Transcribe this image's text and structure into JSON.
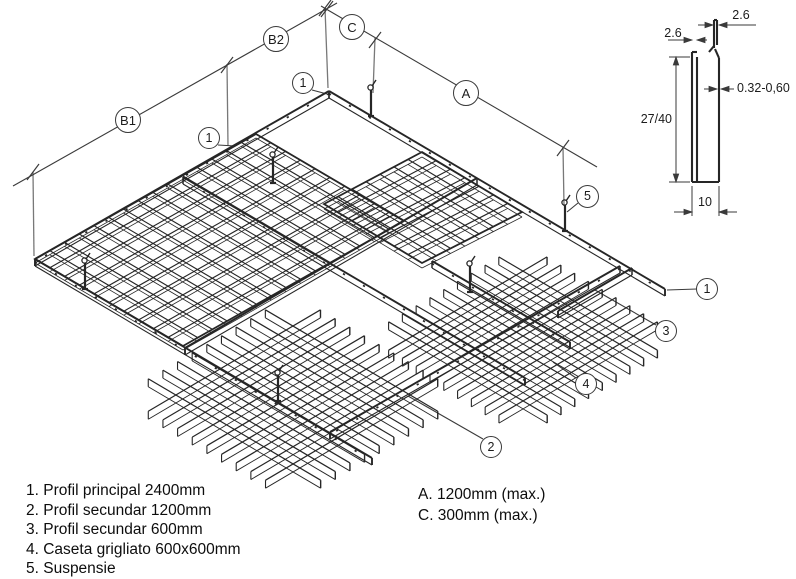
{
  "legend": {
    "items": [
      "1. Profil principal 2400mm",
      "2. Profil secundar 1200mm",
      "3. Profil secundar 600mm",
      "4. Caseta grigliato 600x600mm",
      "5. Suspensie"
    ],
    "dims": [
      "A. 1200mm (max.)",
      "C. 300mm (max.)"
    ]
  },
  "callouts": {
    "b1": "B1",
    "b2": "B2",
    "c": "C",
    "a": "A",
    "one": "1",
    "two": "2",
    "three": "3",
    "four": "4",
    "five": "5"
  },
  "detail": {
    "top_fold": "2.6",
    "left_fold": "2.6",
    "thickness": "0.32-0,60",
    "height": "27/40",
    "width": "10"
  },
  "drawing": {
    "stroke": "#262626",
    "dim_stroke": "#3a3a3a",
    "ext_stroke": "#787878",
    "rails": [
      {
        "x1": 329,
        "y1": 91,
        "x2": 35,
        "y2": 259,
        "h": 7,
        "ticks": true
      },
      {
        "x1": 329,
        "y1": 91,
        "x2": 665,
        "y2": 289,
        "h": 7,
        "ticks": true
      },
      {
        "x1": 35,
        "y1": 259,
        "x2": 372,
        "y2": 458,
        "h": 7,
        "ticks": true
      },
      {
        "x1": 620,
        "y1": 266,
        "x2": 330,
        "y2": 432,
        "h": 7,
        "ticks": true
      },
      {
        "x1": 183,
        "y1": 177,
        "x2": 525,
        "y2": 378,
        "h": 7,
        "ticks": true
      },
      {
        "x1": 477,
        "y1": 178,
        "x2": 185,
        "y2": 348,
        "h": 7,
        "ticks": false
      },
      {
        "x1": 632,
        "y1": 268,
        "x2": 558,
        "y2": 311,
        "h": 7,
        "ticks": false
      },
      {
        "x1": 432,
        "y1": 261,
        "x2": 570,
        "y2": 342,
        "h": 7,
        "ticks": true
      }
    ],
    "panels": [
      {
        "top": [
          256,
          134
        ],
        "right": [
          404,
          221
        ],
        "bottom": [
          183,
          346
        ],
        "left": [
          35,
          259
        ],
        "nr": 10,
        "nl": 15,
        "depth": 4
      },
      {
        "top": [
          422,
          152
        ],
        "right": [
          522,
          212
        ],
        "bottom": [
          422,
          263
        ],
        "left": [
          324,
          204
        ],
        "nr": 7,
        "nl": 7,
        "depth": 5
      }
    ],
    "cassettes": [
      {
        "cx": 293,
        "cy": 395,
        "n": 9,
        "half": 100,
        "gap": 17,
        "depth": 8
      },
      {
        "cx": 523,
        "cy": 336,
        "n": 9,
        "half": 92,
        "gap": 16,
        "depth": 8
      }
    ],
    "hangers": [
      [
        371,
        116
      ],
      [
        273,
        183
      ],
      [
        85,
        289
      ],
      [
        565,
        231
      ],
      [
        470,
        292
      ],
      [
        278,
        401
      ]
    ],
    "dim_lines": [
      [
        337,
        3,
        13,
        186
      ],
      [
        321,
        6,
        597,
        167
      ]
    ],
    "dim_ticks": [
      [
        325,
        8
      ],
      [
        227,
        65
      ],
      [
        33,
        172
      ],
      [
        327,
        9
      ],
      [
        375,
        40
      ],
      [
        563,
        148
      ]
    ],
    "ext_lines": [
      [
        325,
        8,
        328,
        88
      ],
      [
        227,
        64,
        228,
        146
      ],
      [
        33,
        172,
        34,
        256
      ],
      [
        375,
        38,
        373,
        93
      ],
      [
        563,
        147,
        564,
        206
      ]
    ],
    "leaders": [
      [
        312,
        90,
        327,
        94
      ],
      [
        218,
        145,
        235,
        146
      ],
      [
        578,
        203,
        567,
        212
      ],
      [
        697,
        289,
        667,
        290
      ],
      [
        656,
        325,
        595,
        290
      ],
      [
        576,
        378,
        553,
        362
      ],
      [
        483,
        439,
        408,
        396
      ]
    ],
    "detail_profile": [
      [
        692,
        52,
        692,
        182
      ],
      [
        697,
        57,
        697,
        182
      ],
      [
        692,
        52,
        697,
        52
      ],
      [
        692,
        182,
        719,
        182
      ],
      [
        719,
        182,
        719,
        58
      ],
      [
        714,
        20,
        714,
        48
      ],
      [
        717,
        20,
        717,
        45
      ],
      [
        714,
        20,
        717,
        20
      ],
      [
        719,
        58,
        715,
        49
      ],
      [
        714,
        46,
        709,
        52
      ]
    ],
    "detail_dims": [
      [
        676,
        57,
        676,
        182
      ],
      [
        669,
        57,
        690,
        57
      ],
      [
        669,
        182,
        690,
        182
      ],
      [
        698,
        25,
        713,
        25
      ],
      [
        719,
        25,
        756,
        25
      ],
      [
        668,
        40,
        692,
        40
      ],
      [
        697,
        40,
        707,
        40
      ],
      [
        704,
        89,
        717,
        89
      ],
      [
        721,
        89,
        734,
        89
      ],
      [
        692,
        186,
        692,
        216
      ],
      [
        719,
        186,
        719,
        216
      ],
      [
        674,
        212,
        692,
        212
      ],
      [
        719,
        212,
        737,
        212
      ]
    ],
    "detail_arrows": [
      [
        713,
        25,
        "r"
      ],
      [
        719,
        25,
        "l"
      ],
      [
        692,
        40,
        "r"
      ],
      [
        697,
        40,
        "l"
      ],
      [
        717,
        89,
        "r"
      ],
      [
        721,
        89,
        "l"
      ],
      [
        676,
        57,
        "u"
      ],
      [
        676,
        182,
        "d"
      ],
      [
        692,
        212,
        "r"
      ],
      [
        719,
        212,
        "l"
      ]
    ]
  }
}
